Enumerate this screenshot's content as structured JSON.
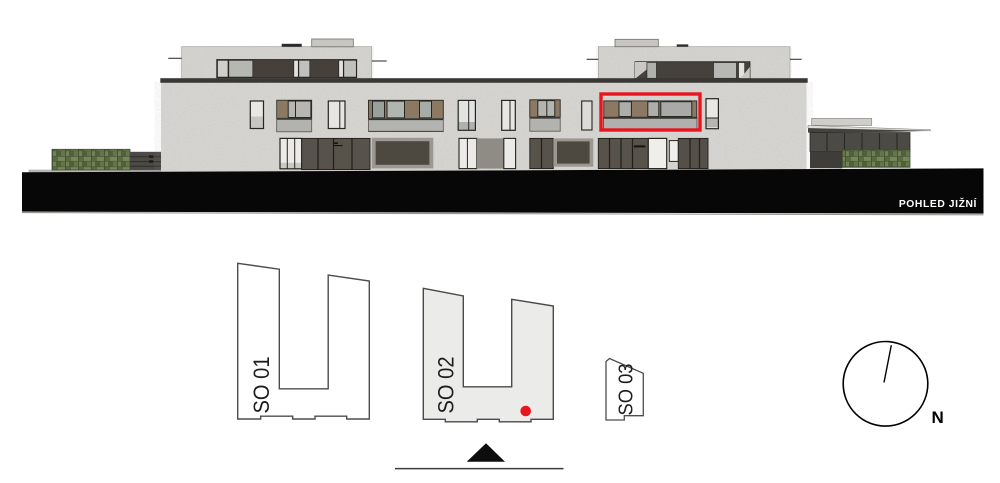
{
  "elevation": {
    "caption": "POHLED JIŽNÍ",
    "highlight_color": "#e8151f"
  },
  "site_plan": {
    "buildings": [
      {
        "label": "SO 01",
        "highlighted": false
      },
      {
        "label": "SO 02",
        "highlighted": true
      },
      {
        "label": "SO 03",
        "highlighted": false
      }
    ],
    "marker_color": "#e8151f",
    "north_label": "N"
  },
  "colors": {
    "facade_gray": "#d8d7d3",
    "ground_band_black": "#070707",
    "selected_building_fill": "#ebebea",
    "hedge_green": "#69794e",
    "dark_glazing": "#57524a",
    "wood_panel": "#8b7963",
    "balcony_parapet": "#b2b2ae"
  }
}
